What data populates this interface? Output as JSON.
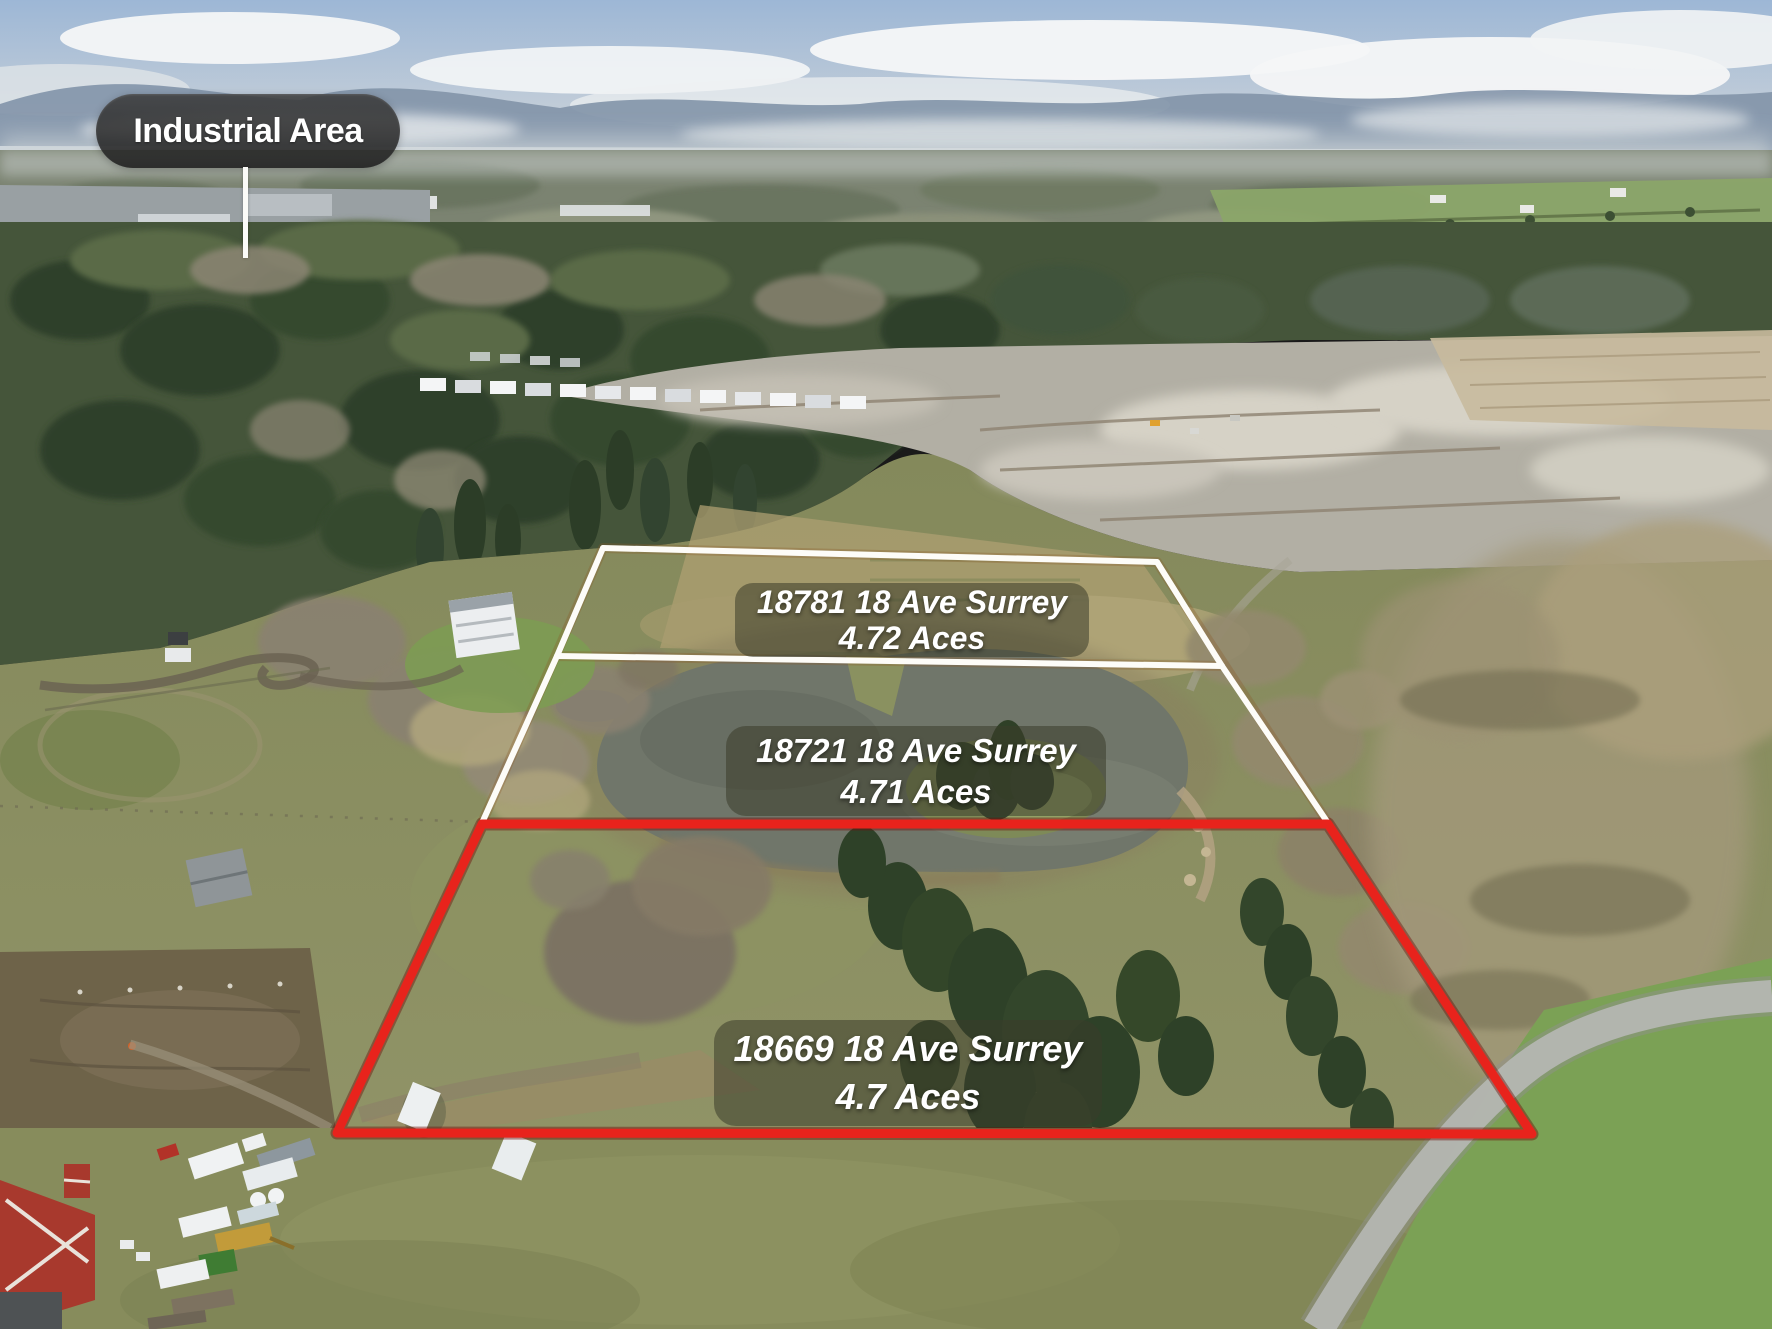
{
  "annotations": {
    "industrial": {
      "label": "Industrial Area"
    },
    "lots": [
      {
        "address": "18781 18 Ave Surrey",
        "area": "4.72 Aces",
        "outline_color": "#fdfcf8"
      },
      {
        "address": "18721 18 Ave Surrey",
        "area": "4.71 Aces",
        "outline_color": "#fdfcf8"
      },
      {
        "address": "18669 18 Ave Surrey",
        "area": "4.7 Aces",
        "outline_color": "#e8231c"
      }
    ],
    "colors": {
      "white_boundary": "#fdfcf8",
      "red_boundary": "#e8231c",
      "label_background": "rgba(58,60,42,0.55)",
      "pill_background": "rgba(40,40,40,0.88)"
    }
  }
}
